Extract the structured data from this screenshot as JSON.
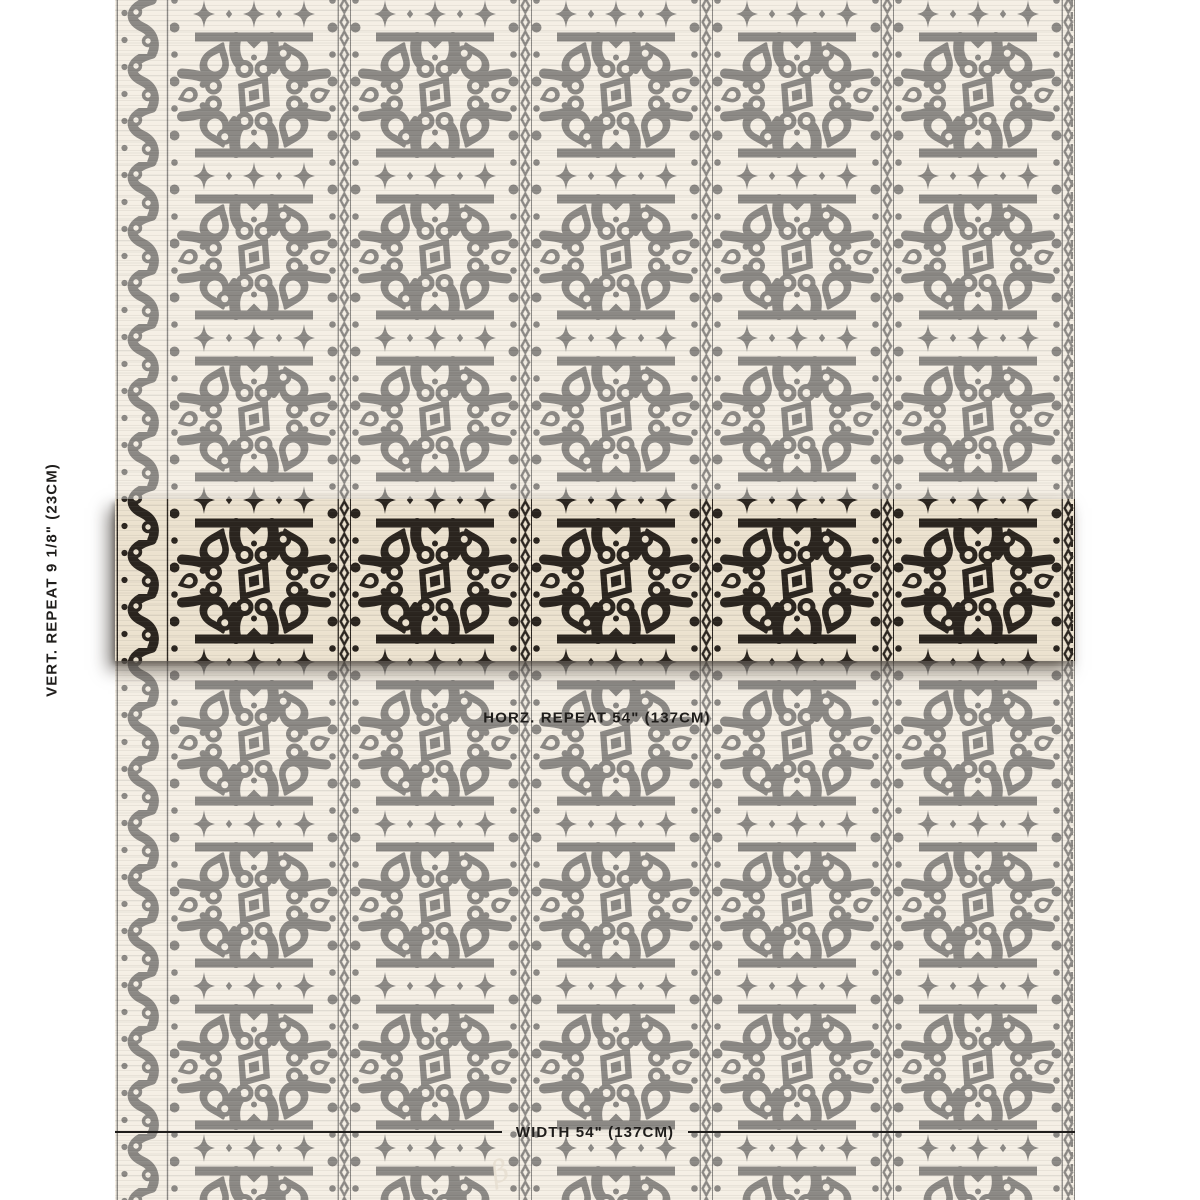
{
  "title": "Fabric swatch with pattern repeat measurements",
  "labels": {
    "vert_repeat": "VERT. REPEAT 9 1/8\" (23CM)",
    "horz_repeat": "HORZ. REPEAT 54\" (137CM)",
    "width": "WIDTH 54\" (137CM)"
  },
  "measurements": {
    "vertical_repeat_in": "9 1/8\"",
    "vertical_repeat_cm": "23CM",
    "horizontal_repeat_in": "54\"",
    "horizontal_repeat_cm": "137CM",
    "width_in": "54\"",
    "width_cm": "137CM"
  },
  "signature": "β",
  "colors": {
    "ink": "#2b251f",
    "ground": "#ece2cf",
    "label": "#1f1d1b",
    "fade": "rgba(255,255,255,0.46)"
  }
}
